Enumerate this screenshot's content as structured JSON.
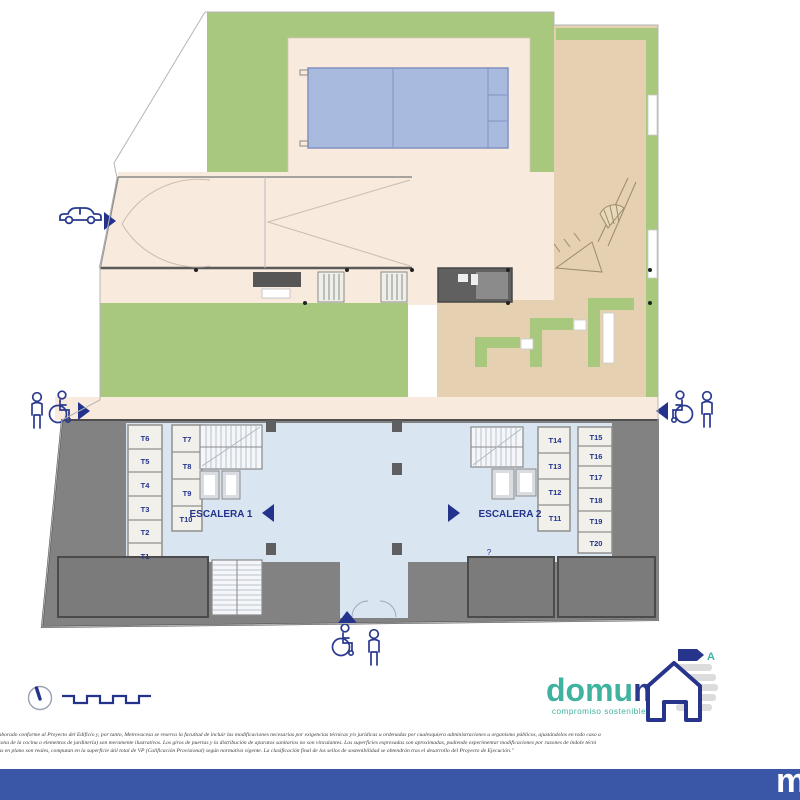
{
  "plan": {
    "stair1_label": "ESCALERA 1",
    "stair2_label": "ESCALERA 2",
    "storage_labels": [
      "T1",
      "T2",
      "T3",
      "T4",
      "T5",
      "T6",
      "T7",
      "T8",
      "T9",
      "T10",
      "T11",
      "T12",
      "T13",
      "T14",
      "T15",
      "T16",
      "T17",
      "T18",
      "T19",
      "T20"
    ],
    "misc_label": "?"
  },
  "branding": {
    "logo_part1": "domu",
    "logo_part2": "m",
    "tagline": "compromiso sostenible",
    "energy_rating_letter": "A",
    "footer_mark": "m"
  },
  "footer": {
    "disclaimer_line1": "ido elaborado conforme al Proyecto del Edificio y, por tanto, Metrovacesa se reserva la facultad de incluir las modificaciones necesarias por exigencias técnicas y/o jurídicas u ordenadas por cualesquiera administraciones u organismo públicos, ajustándolos en todo caso a",
    "disclaimer_line2": "en la zona de la cocina o elementos de jardinería) son meramente ilustrativos. Los giros de puertas y la distribución de aparatos sanitarios no son vinculantes. Las superficies expresadas son aproximadas, pudiendo experimentar modificaciones por razones de índole técni",
    "disclaimer_line3": "dejadas en plano son reales, computan en la superficie útil total de VP (Calificación Provisional) según normativa vigente. La clasificación final de los sellos de sostenibilidad se obtendrán tras el desarrollo del Proyecto de Ejecución.\""
  },
  "colors": {
    "accent_navy": "#23338C",
    "teal": "#3FB3A0",
    "grass_green": "#A8C87E",
    "deck_beige": "#F8EADD",
    "sand_tan": "#E5D0B1",
    "pool_blue": "#A9BADF",
    "floor_blue": "#DAE5F2",
    "wall_gray": "#828282",
    "footer_blue": "#3A56A7"
  }
}
